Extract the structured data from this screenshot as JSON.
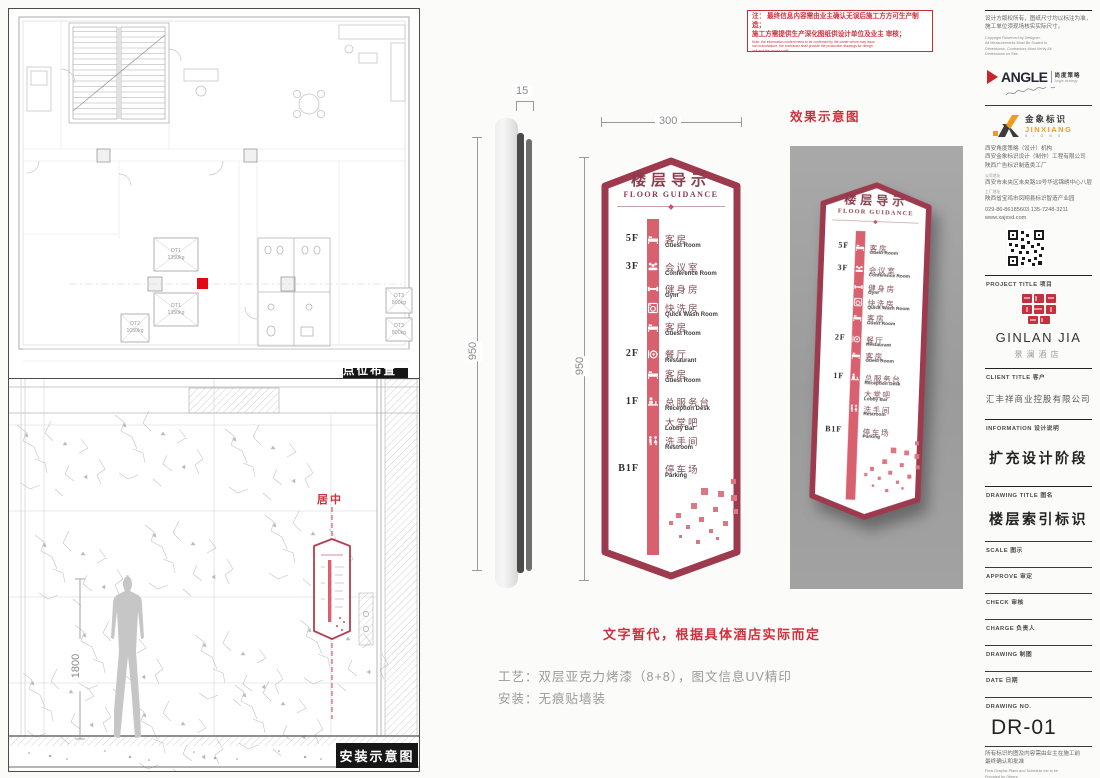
{
  "sheet_labels": {
    "plan": "点位布置图",
    "install": "安装示意图",
    "render": "效果示意图"
  },
  "note_box": {
    "line1": "注： 最终信息内容需由业主确认无误后施工方方可生产制造；",
    "line2": "施工方需提供生产深化图纸供设计单位及业主 审核；",
    "en_lines": [
      "Note: the information content need to be confirmed by the owner whom may issue",
      "can manufacture, the contractor shall provide the production drawings for design",
      "unit and the owner audit;"
    ]
  },
  "dimensions": {
    "thickness": "15",
    "sign_width": "300",
    "side_height": "950",
    "front_height": "950",
    "person_height": "1800"
  },
  "plan": {
    "dt1": "DT1",
    "dt1_load": "1350kg",
    "dt2": "DT2",
    "dt2_load": "1050kg",
    "dt3": "DT3",
    "dt3_load": "800kg"
  },
  "install_view": {
    "center_note": "居中"
  },
  "sign": {
    "title_zh": "楼层导示",
    "title_en": "FLOOR GUIDANCE",
    "entries": [
      {
        "floor": "5F",
        "icon": "bed-icon",
        "zh": "客房",
        "en": "Guest Room"
      },
      {
        "floor": "3F",
        "icon": "meeting-icon",
        "zh": "会议室",
        "en": "Conference Room"
      },
      {
        "floor": "",
        "icon": "gym-icon",
        "zh": "健身房",
        "en": "Gym"
      },
      {
        "floor": "",
        "icon": "wash-icon",
        "zh": "快洗房",
        "en": "Quick Wash Room"
      },
      {
        "floor": "",
        "icon": "bed-icon",
        "zh": "客房",
        "en": "Guest Room"
      },
      {
        "floor": "2F",
        "icon": "restaurant-icon",
        "zh": "餐厅",
        "en": "Restaurant"
      },
      {
        "floor": "",
        "icon": "bed-icon",
        "zh": "客房",
        "en": "Guest Room"
      },
      {
        "floor": "1F",
        "icon": "reception-icon",
        "zh": "总服务台",
        "en": "Reception Desk"
      },
      {
        "floor": "",
        "icon": "",
        "zh": "大堂吧",
        "en": "Lobby Bar"
      },
      {
        "floor": "",
        "icon": "restroom-icon",
        "zh": "洗手间",
        "en": "Restroom"
      },
      {
        "floor": "B1F",
        "icon": "",
        "zh": "停车场",
        "en": "Parking"
      }
    ]
  },
  "notes": {
    "temp": "文字暂代，根据具体酒店实际而定",
    "process": "工艺：双层亚克力烤漆（8+8），图文信息UV精印",
    "mount": "安装：无痕贴墙装"
  },
  "colors": {
    "sign_border": "#9e3a4e",
    "sign_strip": "#d9616f",
    "accent_red": "#d03440",
    "angle_red": "#cc2229",
    "jinxiang_orange": "#f29b1d",
    "marker_red": "#e30613"
  },
  "titleblock": {
    "copyright_cn_1": "设计方版权所有，图纸尺寸均以标注为准，",
    "copyright_cn_2": "施工单位须现场核实实际尺寸。",
    "copyright_en": [
      "Copyright Reserved by Designer.",
      "All Measurements Must Be Scaled to",
      "Dimensions, Contractors Must Verify All",
      "Dimensions on Site."
    ],
    "angle": {
      "wordmark": "ANGLE",
      "cn": "尚度策略",
      "en": "Angle strategy"
    },
    "jinxiang": {
      "cn": "金象标识",
      "en": "JINXIANG",
      "sub": "S I G N S"
    },
    "org_lines": [
      "西安角度策略（设计）机构",
      "西安金象标识设计（制作）工程有限公司",
      "陕西广告标识制造类工厂"
    ],
    "addr_company_label": "公司地址",
    "addr_company": "西安市未央区未央路19号华远锦绣中心八层",
    "addr_factory_label": "工厂地址",
    "addr_factory": "陕西省宝鸡市凤翔县标识智造产业园",
    "phone": "029-86-86185603  135-7248-3211",
    "website": "www.xajxsd.com",
    "project_label": "PROJECT TITLE 项目",
    "project_name": "GINLAN JIA",
    "project_cn": "景澜酒店",
    "client_label": "CLIENT TITLE 客户",
    "client_name": "汇丰祥商业控股有限公司",
    "info_label": "INFORMATION 设计说明",
    "info_value": "扩充设计阶段",
    "drawing_title_label": "DRAWING TITLE 图名",
    "drawing_title": "楼层索引标识",
    "fields": [
      "SCALE 图示",
      "APPROVE 审定",
      "CHECK 审核",
      "CHARGE 负责人",
      "DRAWING 制图",
      "DATE 日期"
    ],
    "drawing_no_label": "DRAWING NO.",
    "drawing_no": "DR-01",
    "footer_cn_1": "所有标识的图及内容需由业主在施工前",
    "footer_cn_2": "最终确认和批准",
    "footer_en_1": "Final Graphic Plans and Schedule etc to be",
    "footer_en_2": "Provided by Others."
  }
}
